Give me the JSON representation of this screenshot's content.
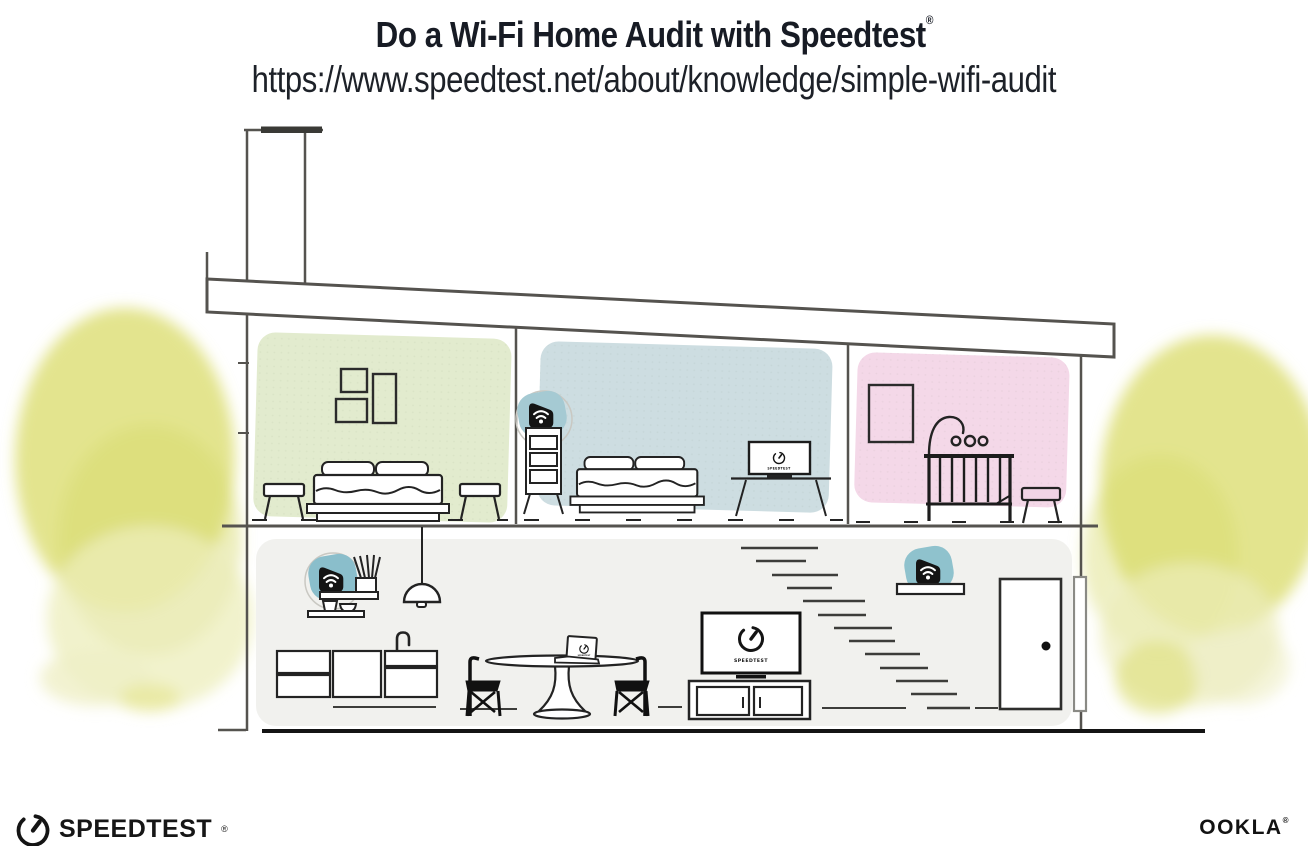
{
  "header": {
    "title": "Do a Wi-Fi Home Audit with Speedtest",
    "title_mark": "®",
    "url": "https://www.speedtest.net/about/knowledge/simple-wifi-audit"
  },
  "illustration": {
    "screens": {
      "bedroom_tv_label": "SPEEDTEST",
      "living_tv_label": "SPEEDTEST",
      "laptop_label": "SPEEDTEST"
    },
    "icons": {
      "wifi_router": "black badge with white wi-fi arcs",
      "speedtest_gauge": "open circle gauge with needle"
    },
    "colors": {
      "room_green": "#e2ebce",
      "room_blue": "#cddde1",
      "room_pink": "#f4d8e8",
      "first_floor_gray": "#f1f1ee",
      "tree_yellow": "#dcdd72",
      "tree_wash": "#ecedbb",
      "router_teal": "#8fc0ca",
      "line_ink": "#232323",
      "wall_gray": "#55534f"
    }
  },
  "footer": {
    "speedtest_label": "SPEEDTEST",
    "speedtest_mark": "®",
    "ookla_label": "OOKLA",
    "ookla_mark": "®"
  }
}
